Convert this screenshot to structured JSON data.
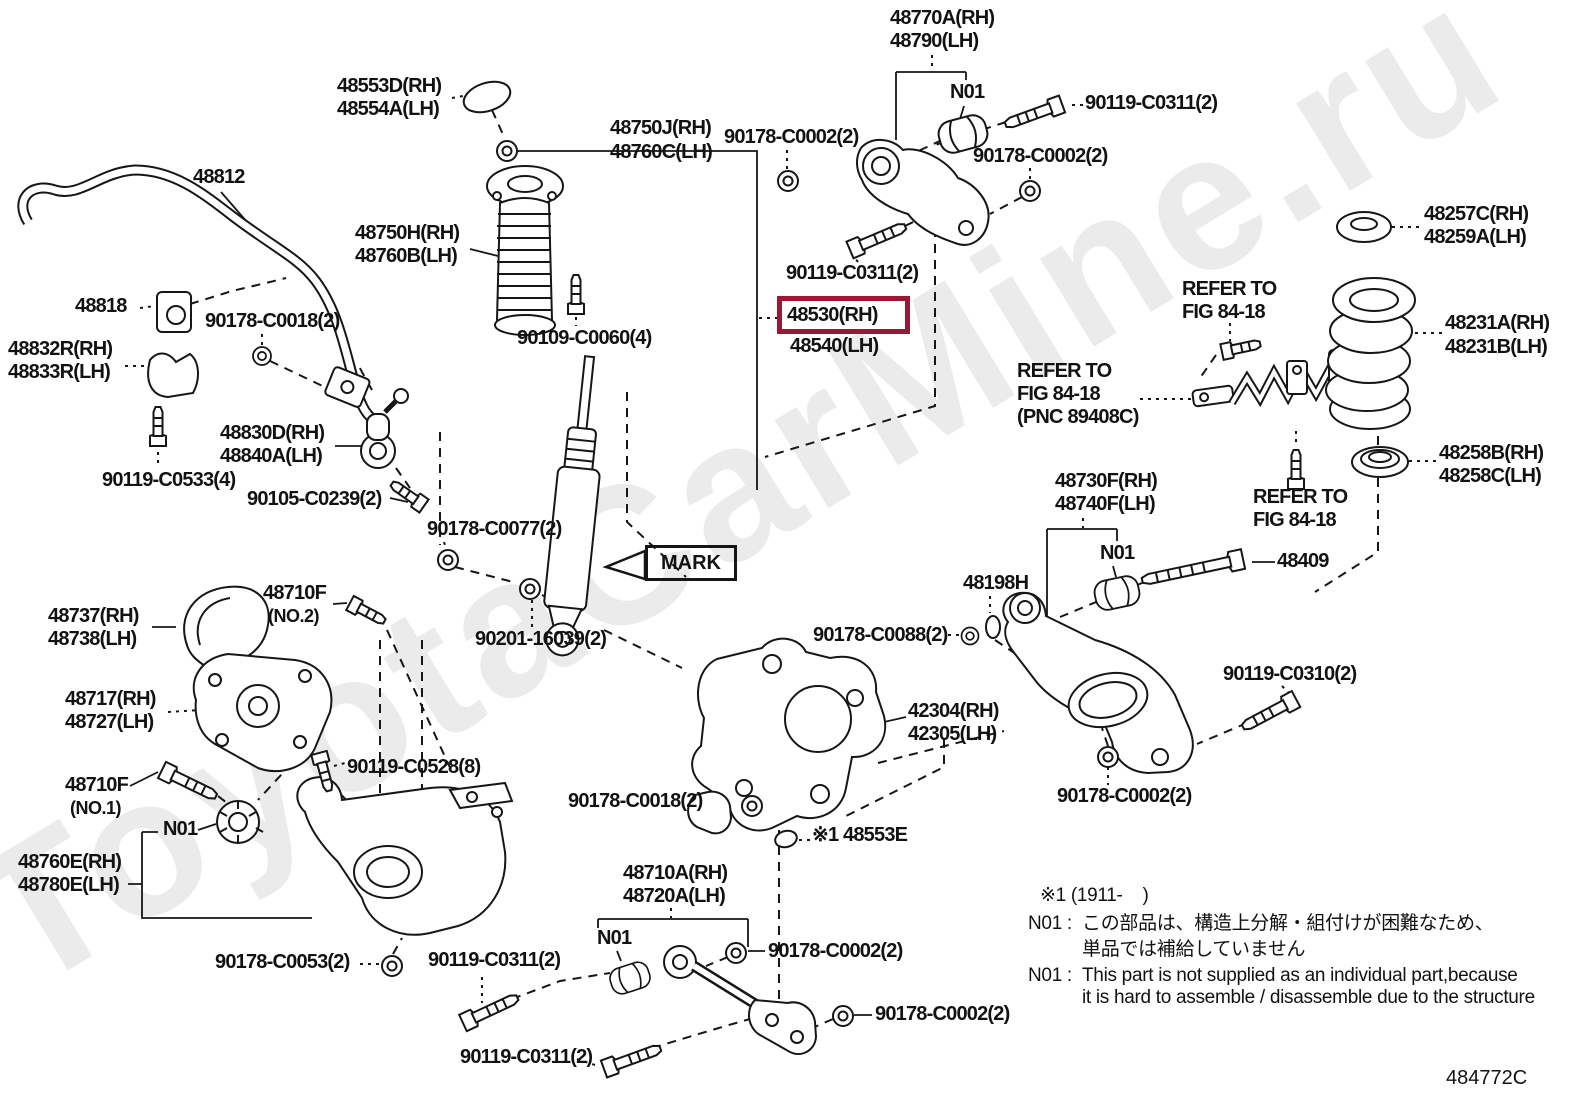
{
  "diagram": {
    "title_hidden": "",
    "watermark": "ToyotaCarMine.ru",
    "figure_code": "484772C",
    "highlight_color": "#9b1733",
    "highlighted_part": "48530(RH)",
    "labels": [
      {
        "t": "48770A(RH)",
        "x": 890,
        "y": 8,
        "v": "part"
      },
      {
        "t": "48790(LH)",
        "x": 890,
        "y": 31,
        "v": "part"
      },
      {
        "t": "N01",
        "x": 950,
        "y": 82,
        "v": "part"
      },
      {
        "t": "90119-C0311(2)",
        "x": 1085,
        "y": 93,
        "v": "part"
      },
      {
        "t": "48553D(RH)",
        "x": 337,
        "y": 76,
        "v": "part"
      },
      {
        "t": "48554A(LH)",
        "x": 337,
        "y": 99,
        "v": "part"
      },
      {
        "t": "90178-C0002(2)",
        "x": 724,
        "y": 127,
        "v": "part"
      },
      {
        "t": "48750J(RH)",
        "x": 610,
        "y": 118,
        "v": "part"
      },
      {
        "t": "48760C(LH)",
        "x": 610,
        "y": 142,
        "v": "part"
      },
      {
        "t": "90178-C0002(2)",
        "x": 973,
        "y": 146,
        "v": "part"
      },
      {
        "t": "48812",
        "x": 193,
        "y": 167,
        "v": "part"
      },
      {
        "t": "48257C(RH)",
        "x": 1424,
        "y": 204,
        "v": "part"
      },
      {
        "t": "48259A(LH)",
        "x": 1424,
        "y": 227,
        "v": "part"
      },
      {
        "t": "48750H(RH)",
        "x": 355,
        "y": 223,
        "v": "part"
      },
      {
        "t": "48760B(LH)",
        "x": 355,
        "y": 246,
        "v": "part"
      },
      {
        "t": "90119-C0311(2)",
        "x": 786,
        "y": 263,
        "v": "part"
      },
      {
        "t": "REFER TO",
        "x": 1182,
        "y": 279,
        "v": "part"
      },
      {
        "t": "FIG 84-18",
        "x": 1182,
        "y": 302,
        "v": "part"
      },
      {
        "t": "48818",
        "x": 75,
        "y": 296,
        "v": "part"
      },
      {
        "t": "90178-C0018(2)",
        "x": 205,
        "y": 311,
        "v": "part"
      },
      {
        "t": "48530(RH)",
        "x": 777,
        "y": 296,
        "v": "hl"
      },
      {
        "t": "48540(LH)",
        "x": 790,
        "y": 336,
        "v": "part"
      },
      {
        "t": "48231A(RH)",
        "x": 1445,
        "y": 313,
        "v": "part"
      },
      {
        "t": "48231B(LH)",
        "x": 1445,
        "y": 337,
        "v": "part"
      },
      {
        "t": "48832R(RH)",
        "x": 8,
        "y": 339,
        "v": "part"
      },
      {
        "t": "48833R(LH)",
        "x": 8,
        "y": 362,
        "v": "part"
      },
      {
        "t": "90109-C0060(4)",
        "x": 517,
        "y": 328,
        "v": "part"
      },
      {
        "t": "REFER TO",
        "x": 1017,
        "y": 361,
        "v": "part"
      },
      {
        "t": "FIG 84-18",
        "x": 1017,
        "y": 384,
        "v": "part"
      },
      {
        "t": "(PNC 89408C)",
        "x": 1017,
        "y": 407,
        "v": "part"
      },
      {
        "t": "48830D(RH)",
        "x": 220,
        "y": 423,
        "v": "part"
      },
      {
        "t": "48840A(LH)",
        "x": 220,
        "y": 446,
        "v": "part"
      },
      {
        "t": "90119-C0533(4)",
        "x": 102,
        "y": 470,
        "v": "part"
      },
      {
        "t": "48258B(RH)",
        "x": 1439,
        "y": 443,
        "v": "part"
      },
      {
        "t": "48258C(LH)",
        "x": 1439,
        "y": 466,
        "v": "part"
      },
      {
        "t": "90105-C0239(2)",
        "x": 247,
        "y": 489,
        "v": "part"
      },
      {
        "t": "48730F(RH)",
        "x": 1055,
        "y": 471,
        "v": "part"
      },
      {
        "t": "48740F(LH)",
        "x": 1055,
        "y": 494,
        "v": "part"
      },
      {
        "t": "REFER TO",
        "x": 1253,
        "y": 487,
        "v": "part"
      },
      {
        "t": "FIG 84-18",
        "x": 1253,
        "y": 510,
        "v": "part"
      },
      {
        "t": "90178-C0077(2)",
        "x": 427,
        "y": 519,
        "v": "part"
      },
      {
        "t": "N01",
        "x": 1100,
        "y": 543,
        "v": "part"
      },
      {
        "t": "48409",
        "x": 1277,
        "y": 551,
        "v": "part"
      },
      {
        "t": "MARK",
        "x": 645,
        "y": 545,
        "v": "box"
      },
      {
        "t": "48198H",
        "x": 963,
        "y": 573,
        "v": "part"
      },
      {
        "t": "48710F",
        "x": 263,
        "y": 583,
        "v": "part"
      },
      {
        "t": "(NO.2)",
        "x": 268,
        "y": 607,
        "v": "small"
      },
      {
        "t": "48737(RH)",
        "x": 48,
        "y": 606,
        "v": "part"
      },
      {
        "t": "48738(LH)",
        "x": 48,
        "y": 629,
        "v": "part"
      },
      {
        "t": "90201-16039(2)",
        "x": 475,
        "y": 629,
        "v": "part"
      },
      {
        "t": "90178-C0088(2)",
        "x": 813,
        "y": 625,
        "v": "part"
      },
      {
        "t": "90119-C0310(2)",
        "x": 1223,
        "y": 664,
        "v": "part"
      },
      {
        "t": "48717(RH)",
        "x": 65,
        "y": 689,
        "v": "part"
      },
      {
        "t": "48727(LH)",
        "x": 65,
        "y": 712,
        "v": "part"
      },
      {
        "t": "42304(RH)",
        "x": 908,
        "y": 701,
        "v": "part"
      },
      {
        "t": "42305(LH)",
        "x": 908,
        "y": 724,
        "v": "part"
      },
      {
        "t": "90119-C0528(8)",
        "x": 347,
        "y": 757,
        "v": "part"
      },
      {
        "t": "48710F",
        "x": 65,
        "y": 775,
        "v": "part"
      },
      {
        "t": "(NO.1)",
        "x": 70,
        "y": 799,
        "v": "small"
      },
      {
        "t": "90178-C0002(2)",
        "x": 1057,
        "y": 786,
        "v": "part"
      },
      {
        "t": "N01",
        "x": 163,
        "y": 819,
        "v": "part"
      },
      {
        "t": "90178-C0018(2)",
        "x": 568,
        "y": 791,
        "v": "part"
      },
      {
        "t": "※1 48553E",
        "x": 812,
        "y": 825,
        "v": "part"
      },
      {
        "t": "48760E(RH)",
        "x": 18,
        "y": 852,
        "v": "part"
      },
      {
        "t": "48780E(LH)",
        "x": 18,
        "y": 875,
        "v": "part"
      },
      {
        "t": "48710A(RH)",
        "x": 623,
        "y": 863,
        "v": "part"
      },
      {
        "t": "48720A(LH)",
        "x": 623,
        "y": 886,
        "v": "part"
      },
      {
        "t": "N01",
        "x": 597,
        "y": 928,
        "v": "part"
      },
      {
        "t": "90178-C0002(2)",
        "x": 768,
        "y": 941,
        "v": "part"
      },
      {
        "t": "90178-C0053(2)",
        "x": 215,
        "y": 952,
        "v": "part"
      },
      {
        "t": "90119-C0311(2)",
        "x": 428,
        "y": 950,
        "v": "part"
      },
      {
        "t": "90178-C0002(2)",
        "x": 875,
        "y": 1004,
        "v": "part"
      },
      {
        "t": "90119-C0311(2)",
        "x": 460,
        "y": 1047,
        "v": "part"
      },
      {
        "t": "※1 (1911-    )",
        "x": 1040,
        "y": 886,
        "v": "note"
      },
      {
        "t": "N01 :",
        "x": 1028,
        "y": 914,
        "v": "note"
      },
      {
        "t": "この部品は、構造上分解・組付けが困難なため、",
        "x": 1082,
        "y": 914,
        "v": "note"
      },
      {
        "t": "単品では補給していません",
        "x": 1082,
        "y": 940,
        "v": "note"
      },
      {
        "t": "N01 :",
        "x": 1028,
        "y": 966,
        "v": "note"
      },
      {
        "t": "This part is not supplied as an individual part,because",
        "x": 1082,
        "y": 966,
        "v": "note"
      },
      {
        "t": "it is hard to assemble / disassemble due to the structure",
        "x": 1082,
        "y": 988,
        "v": "note"
      },
      {
        "t": "484772C",
        "x": 1446,
        "y": 1068,
        "v": "code"
      }
    ]
  }
}
